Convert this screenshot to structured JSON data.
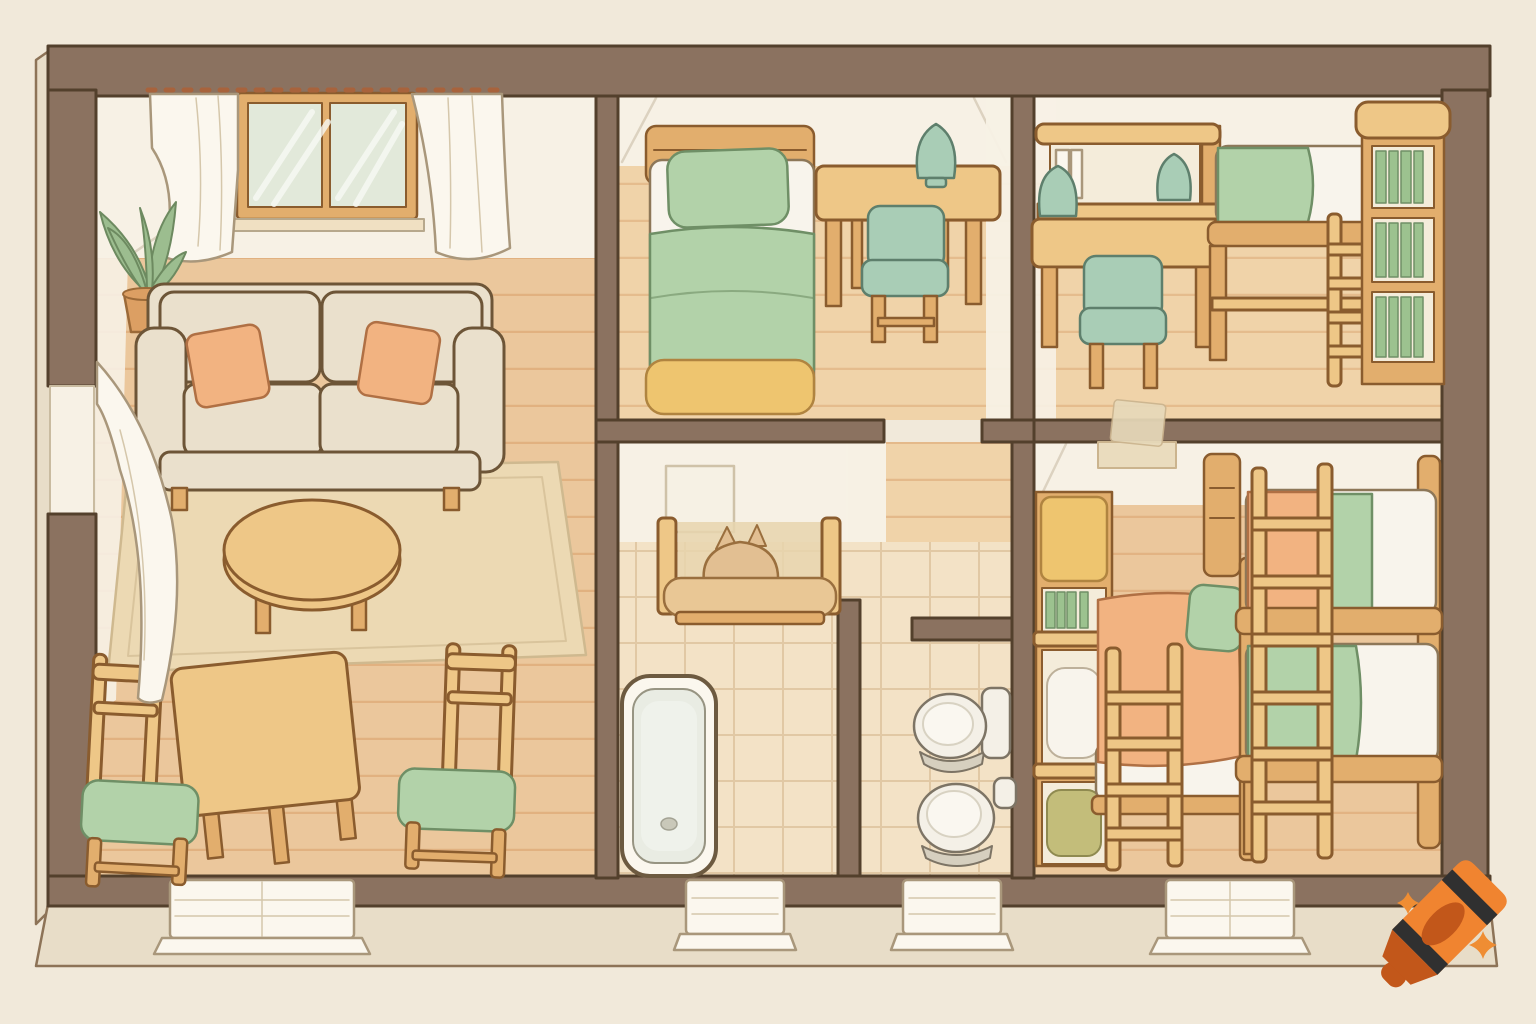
{
  "scene": {
    "title": "Hand-drawn isometric floor plan of a small home",
    "style": "soft pastel colored-pencil illustration, no text labels",
    "rooms": [
      {
        "name": "living-room",
        "position": "left",
        "floor": "wood planks",
        "items": [
          "window with two panes and sheer white curtains",
          "curtain rod with clips",
          "potted plant",
          "two-seat beige sofa",
          "two peach throw pillows",
          "area rug",
          "round wooden coffee table",
          "square dining table",
          "two wooden chairs with green cushions",
          "white drape at left wall window"
        ]
      },
      {
        "name": "bedroom",
        "position": "top-middle",
        "floor": "wood planks",
        "items": [
          "single bed with green pillow, white sheet, green blanket, yellow footboard",
          "writing desk",
          "green cushion chair",
          "green table lamp"
        ]
      },
      {
        "name": "study-room",
        "position": "top-right",
        "floor": "wood planks",
        "items": [
          "desk with hutch and white books",
          "two green lamps",
          "green cushion chair",
          "loft bed with green blanket and wooden ladder",
          "bookshelf with green books"
        ]
      },
      {
        "name": "bathroom",
        "position": "bottom-middle-left",
        "floor": "beige tiles",
        "items": [
          "wall mirror",
          "wooden bench with sleeping cat",
          "white bathtub"
        ]
      },
      {
        "name": "toilet-room",
        "position": "bottom-middle-right",
        "floor": "beige tiles",
        "items": [
          "two white toilets"
        ]
      },
      {
        "name": "kids-room",
        "position": "bottom-right",
        "floor": "wood planks",
        "items": [
          "storage cubby with green books, white pillow and olive pillow",
          "bed with peach blanket and green pillow",
          "wooden ladder",
          "bunk bed with peach and green bedding and ladder",
          "paper taped over doorway in top wall"
        ]
      }
    ],
    "structure": {
      "exterior_openings": [
        "top-wall window in living room",
        "left-wall window with drape",
        "four white door sills along bottom wall"
      ],
      "hallway": "wood corridor between bedroom and washroom leading toward right rooms"
    }
  },
  "watermark": {
    "name": "crayon-logo",
    "description": "orange crayon with two black stripes, dark tip, and two orange sparkles"
  },
  "palette": {
    "bg": "#f1e9da",
    "base": "#e8ddc8",
    "baseline": "#8d7357",
    "wall": "#8b7260",
    "wallline": "#53402c",
    "white": "#f7f1e5",
    "wood_floor": "#ebc79c",
    "wood_floor2": "#f0d3a9",
    "plankline": "#d89f6a",
    "tile": "#f3e2c6",
    "tileline": "#d9bd96",
    "rug": "#ecd9b3",
    "wood": "#eec787",
    "wood2": "#e2ae6d",
    "woodline": "#8a5c2e",
    "slotbg": "#f4ecda",
    "sofa": "#eae0cc",
    "sofaline": "#6d5537",
    "peach": "#f2b381",
    "peachline": "#b07044",
    "green": "#b2d2a9",
    "greenline": "#6f8f66",
    "teal": "#a9cdb6",
    "tealline": "#5e7f6c",
    "cream": "#fbf7ee",
    "blanket_white": "#f8f4ec",
    "yellow": "#eec56f",
    "olive": "#c3bd7a",
    "porcelain": "#f4f0e7",
    "porcelain_shadow": "#d6cfbf",
    "porcline": "#7d7465",
    "leaf": "#9cbd8f",
    "leafline": "#6d8a60",
    "pot": "#dc9f63",
    "potline": "#9c6a38",
    "glass": "#e2e9da",
    "crayon": "#f08430",
    "crayon_dark": "#c2571a",
    "crayon_stripe": "#303030",
    "sparkle": "#ef8d33"
  }
}
